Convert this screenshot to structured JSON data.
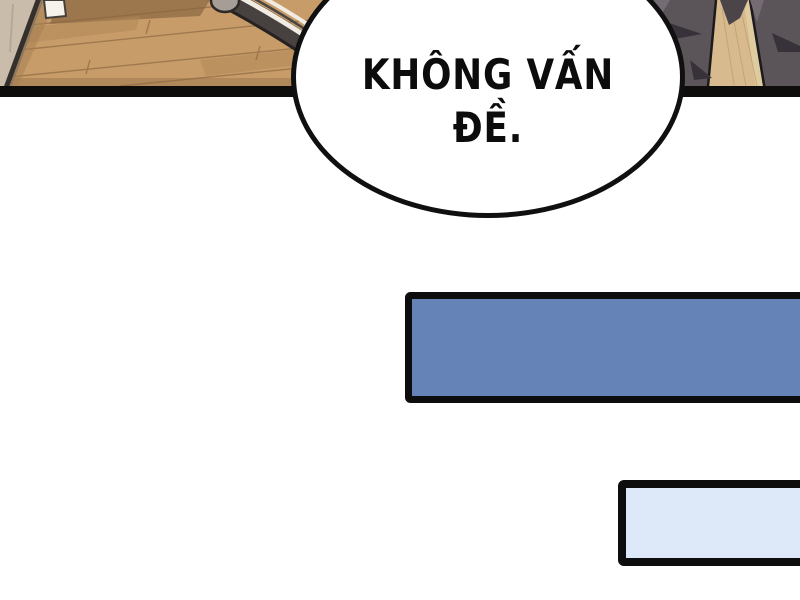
{
  "scene": {
    "kind": "comic-panel",
    "bubble": {
      "line1": "KHÔNG VẤN",
      "line2": "ĐỀ.",
      "full_text": "KHÔNG VẤN ĐỀ."
    },
    "colors": {
      "background": "#ffffff",
      "panel_bar": "#0e0d0c",
      "floor_base": "#c79c69",
      "floor_seam": "#8a6640",
      "floor_patch_dark": "#8a6742",
      "floor_patch_mid": "#b08557",
      "floor_bottom_shade": "#9b744a",
      "wall": "#c9bcab",
      "baseboard": "#35302b",
      "baseboard_shadow": "#a57e52",
      "outlet": "#f6f3ec",
      "tire_outline": "#262221",
      "tire": "#474140",
      "rim_stripe": "#f1ebe1",
      "rim_line": "#4a4543",
      "pedal": "#a69d96",
      "pants": "#5b5459",
      "pants_highlight": "#756c73",
      "pants_shadow": "#37323a",
      "floor_wedge": "#d7ba8e",
      "wedge_light": "#e0cda2",
      "wedge_grain": "#b99765",
      "cuff": "#4b4449",
      "leg_outline": "#1d1a1d",
      "bubble_fill": "#ffffff",
      "bubble_border": "#101010",
      "box_border": "#0d0d0d",
      "blue_box_fill": "#6583b7",
      "light_box_fill": "#dde9f8"
    }
  }
}
